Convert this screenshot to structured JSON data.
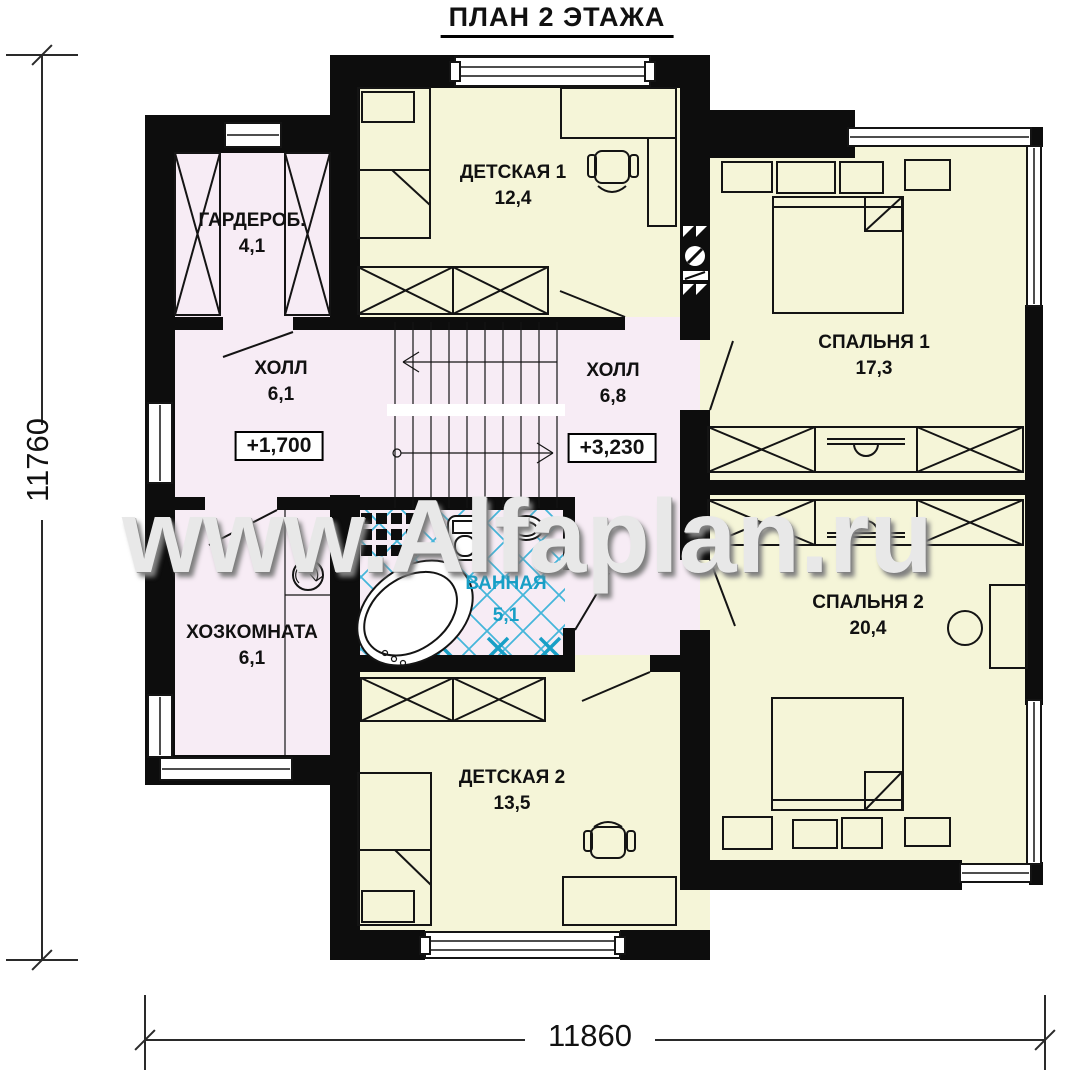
{
  "title": "ПЛАН 2 ЭТАЖА",
  "watermark": "www.Alfaplan.ru",
  "dimensions": {
    "left": "11760",
    "bottom": "11860"
  },
  "rooms": {
    "detskaya1": {
      "name": "ДЕТСКАЯ 1",
      "area": "12,4"
    },
    "garderob": {
      "name": "ГАРДЕРОБ.",
      "area": "4,1"
    },
    "hall1": {
      "name": "ХОЛЛ",
      "area": "6,1",
      "level": "+1,700"
    },
    "hall2": {
      "name": "ХОЛЛ",
      "area": "6,8",
      "level": "+3,230"
    },
    "spalnya1": {
      "name": "СПАЛЬНЯ 1",
      "area": "17,3"
    },
    "hozkomnata": {
      "name": "ХОЗКОМНАТА",
      "area": "6,1"
    },
    "vannaya": {
      "name": "ВАННАЯ",
      "area": "5,1"
    },
    "detskaya2": {
      "name": "ДЕТСКАЯ 2",
      "area": "13,5"
    },
    "spalnya2": {
      "name": "СПАЛЬНЯ 2",
      "area": "20,4"
    }
  },
  "colors": {
    "wall": "#0d0d0d",
    "room_warm": "#f5f5d8",
    "room_pink": "#f7ecf5",
    "tile": "#45b6da",
    "accent_cyan": "#189fc6",
    "dim_line": "#2a2a2a",
    "watermark_gray": "#e8e8e8"
  }
}
